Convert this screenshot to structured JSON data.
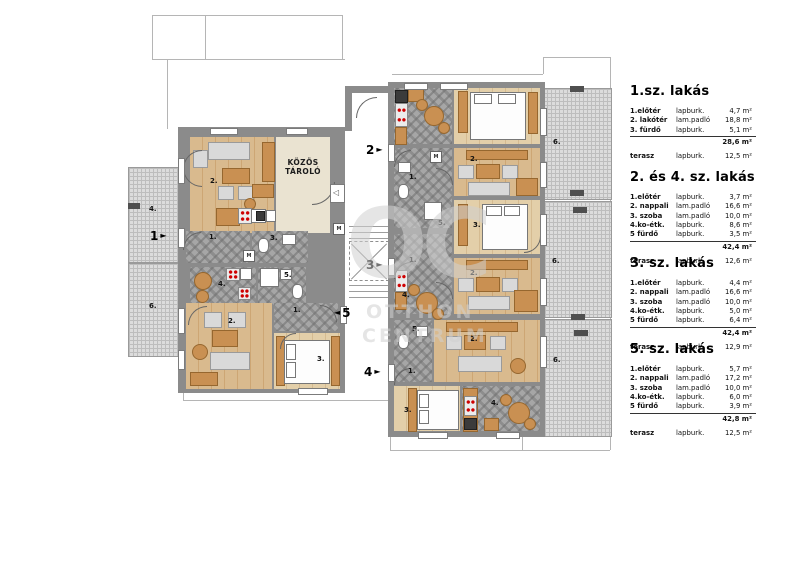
{
  "legend": {
    "sections": [
      {
        "title": "1.sz. lakás",
        "rows": [
          {
            "name": "1.előtér",
            "material": "lapburk.",
            "area": "4,7 m²"
          },
          {
            "name": "2. lakótér",
            "material": "lam.padló",
            "area": "18,8 m²"
          },
          {
            "name": "3. fürdő",
            "material": "lapburk.",
            "area": "5,1 m²"
          }
        ],
        "total": "28,6 m²",
        "terrace": {
          "name": "terasz",
          "material": "lapburk.",
          "area": "12,5 m²"
        }
      },
      {
        "title": "2. és 4. sz. lakás",
        "rows": [
          {
            "name": "1.előtér",
            "material": "lapburk.",
            "area": "3,7 m²"
          },
          {
            "name": "2. nappali",
            "material": "lam.padló",
            "area": "16,6 m²"
          },
          {
            "name": "3. szoba",
            "material": "lam.padló",
            "area": "10,0 m²"
          },
          {
            "name": "4.ko-étk.",
            "material": "lapburk.",
            "area": "8,6 m²"
          },
          {
            "name": "5 fürdő",
            "material": "lapburk.",
            "area": "3,5 m²"
          }
        ],
        "total": "42,4 m²",
        "terrace": {
          "name": "terasz",
          "material": "lapburk.",
          "area": "12,6 m²"
        }
      },
      {
        "title": "3. sz. lakás",
        "rows": [
          {
            "name": "1.előtér",
            "material": "lapburk.",
            "area": "4,4 m²"
          },
          {
            "name": "2. nappali",
            "material": "lam.padló",
            "area": "16,6 m²"
          },
          {
            "name": "3. szoba",
            "material": "lam.padló",
            "area": "10,0 m²"
          },
          {
            "name": "4.ko-étk.",
            "material": "lapburk.",
            "area": "5,0 m²"
          },
          {
            "name": "5 fürdő",
            "material": "lapburk.",
            "area": "6,4 m²"
          }
        ],
        "total": "42,4 m²",
        "terrace": {
          "name": "terasz",
          "material": "lapburk.",
          "area": "12,9 m²"
        }
      },
      {
        "title": "5. sz. lakás",
        "rows": [
          {
            "name": "1.előtér",
            "material": "lapburk.",
            "area": "5,7 m²"
          },
          {
            "name": "2. nappali",
            "material": "lam.padló",
            "area": "17,2 m²"
          },
          {
            "name": "3. szoba",
            "material": "lam.padló",
            "area": "10,0 m²"
          },
          {
            "name": "4.ko-étk.",
            "material": "lapburk.",
            "area": "6,0 m²"
          },
          {
            "name": "5 fürdő",
            "material": "lapburk.",
            "area": "3,9 m²"
          }
        ],
        "total": "42,8 m²",
        "terrace": {
          "name": "terasz",
          "material": "lapburk.",
          "area": "12,5 m²"
        }
      }
    ]
  },
  "plan": {
    "storage_line1": "KÖZÖS",
    "storage_line2": "TÁROLÓ",
    "labels": {
      "roof4": "4.",
      "roof6a": "6.",
      "roof6b": "6.",
      "roof6c": "6.",
      "roof6d": "6.",
      "lu_living": "2.",
      "lu_hall": "1.",
      "lu_bath": "3.",
      "m1": "M",
      "m2": "M",
      "m3": "M",
      "k5_kitchen": "4.",
      "k5_bath": "5.",
      "k5_living": "2.",
      "k5_hall": "1.",
      "k5_room": "3.",
      "a2_living": "2.",
      "a2_hall": "1.",
      "a2_bath": "5.",
      "a3_room": "3.",
      "a3_hall": "1.",
      "a3_kitchen": "4.",
      "a3_living": "2.",
      "a4_bath": "5.",
      "a4_living": "2.",
      "a4_hall": "1.",
      "a4_room": "3.",
      "a4_kitchen": "4.",
      "door_marker": "◁"
    },
    "entrances": {
      "e1": "1",
      "e2": "2",
      "e3": "3",
      "e4": "4",
      "e5": "5",
      "arrow_right": "►",
      "arrow_left": "◄"
    },
    "watermark": {
      "logo": "OC",
      "line1": "OTTHON",
      "line2": "CENTRUM"
    }
  }
}
